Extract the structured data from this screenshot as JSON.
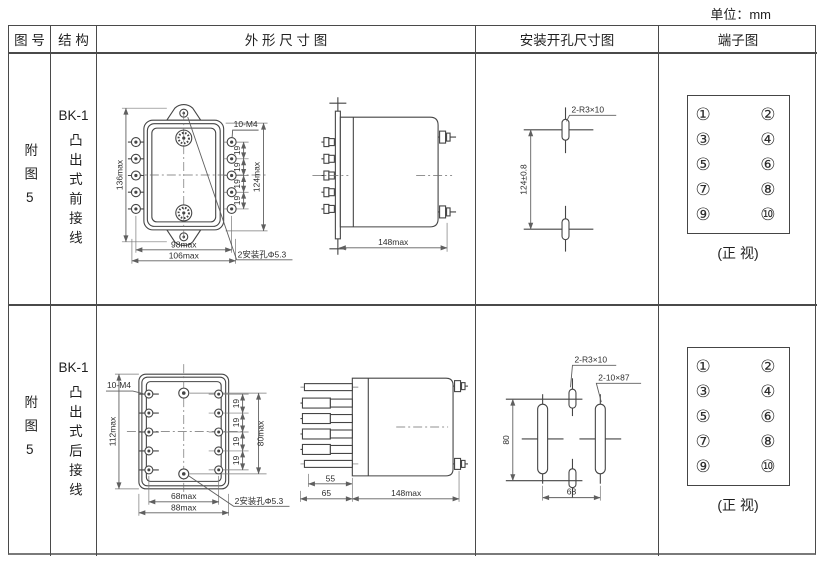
{
  "meta": {
    "unit_label": "单位：mm"
  },
  "table": {
    "headers": {
      "figure_no": "图 号",
      "structure": "结 构",
      "outline": "外 形 尺 寸 图",
      "mounting": "安装开孔尺寸图",
      "terminal": "端子图"
    }
  },
  "rows": [
    {
      "figure_no": "附图5",
      "model": "BK-1",
      "structure_type": "凸出式前接线",
      "outline_front": {
        "overall_height": "136max",
        "terminal_span": "124max",
        "pitch": [
          "19",
          "19",
          "19",
          "19"
        ],
        "width_inner": "98max",
        "width_overall": "106max",
        "terminal_screw_label": "10-M4",
        "mount_hole_label": "2安装孔Φ5.3"
      },
      "outline_side": {
        "depth": "148max"
      },
      "mounting": {
        "slot_label": "2-R3×10",
        "hole_spacing_v": "124±0.8"
      },
      "terminal_diagram": {
        "left_terminals": [
          "①",
          "③",
          "⑤",
          "⑦",
          "⑨"
        ],
        "right_terminals": [
          "②",
          "④",
          "⑥",
          "⑧",
          "⑩"
        ],
        "caption": "(正 视)"
      }
    },
    {
      "figure_no": "附图5",
      "model": "BK-1",
      "structure_type": "凸出式后接线",
      "outline_front": {
        "overall_height": "112max",
        "terminal_span": "80max",
        "pitch": [
          "19",
          "19",
          "19",
          "19"
        ],
        "width_inner": "68max",
        "width_overall": "88max",
        "terminal_screw_label": "10-M4",
        "mount_hole_label": "2安装孔Φ5.3"
      },
      "outline_side": {
        "stud_len": "55",
        "flange_depth": "65",
        "depth": "148max"
      },
      "mounting": {
        "slot_label": "2-R3×10",
        "slot_label_2": "2-10×87",
        "hole_spacing_v": "80",
        "hole_spacing_h": "68"
      },
      "terminal_diagram": {
        "left_terminals": [
          "①",
          "③",
          "⑤",
          "⑦",
          "⑨"
        ],
        "right_terminals": [
          "②",
          "④",
          "⑥",
          "⑧",
          "⑩"
        ],
        "caption": "(正 视)"
      }
    }
  ],
  "colors": {
    "background": "#ffffff",
    "line": "#454545",
    "dim_line": "#5f5f5f",
    "text": "#1f1f1f"
  }
}
